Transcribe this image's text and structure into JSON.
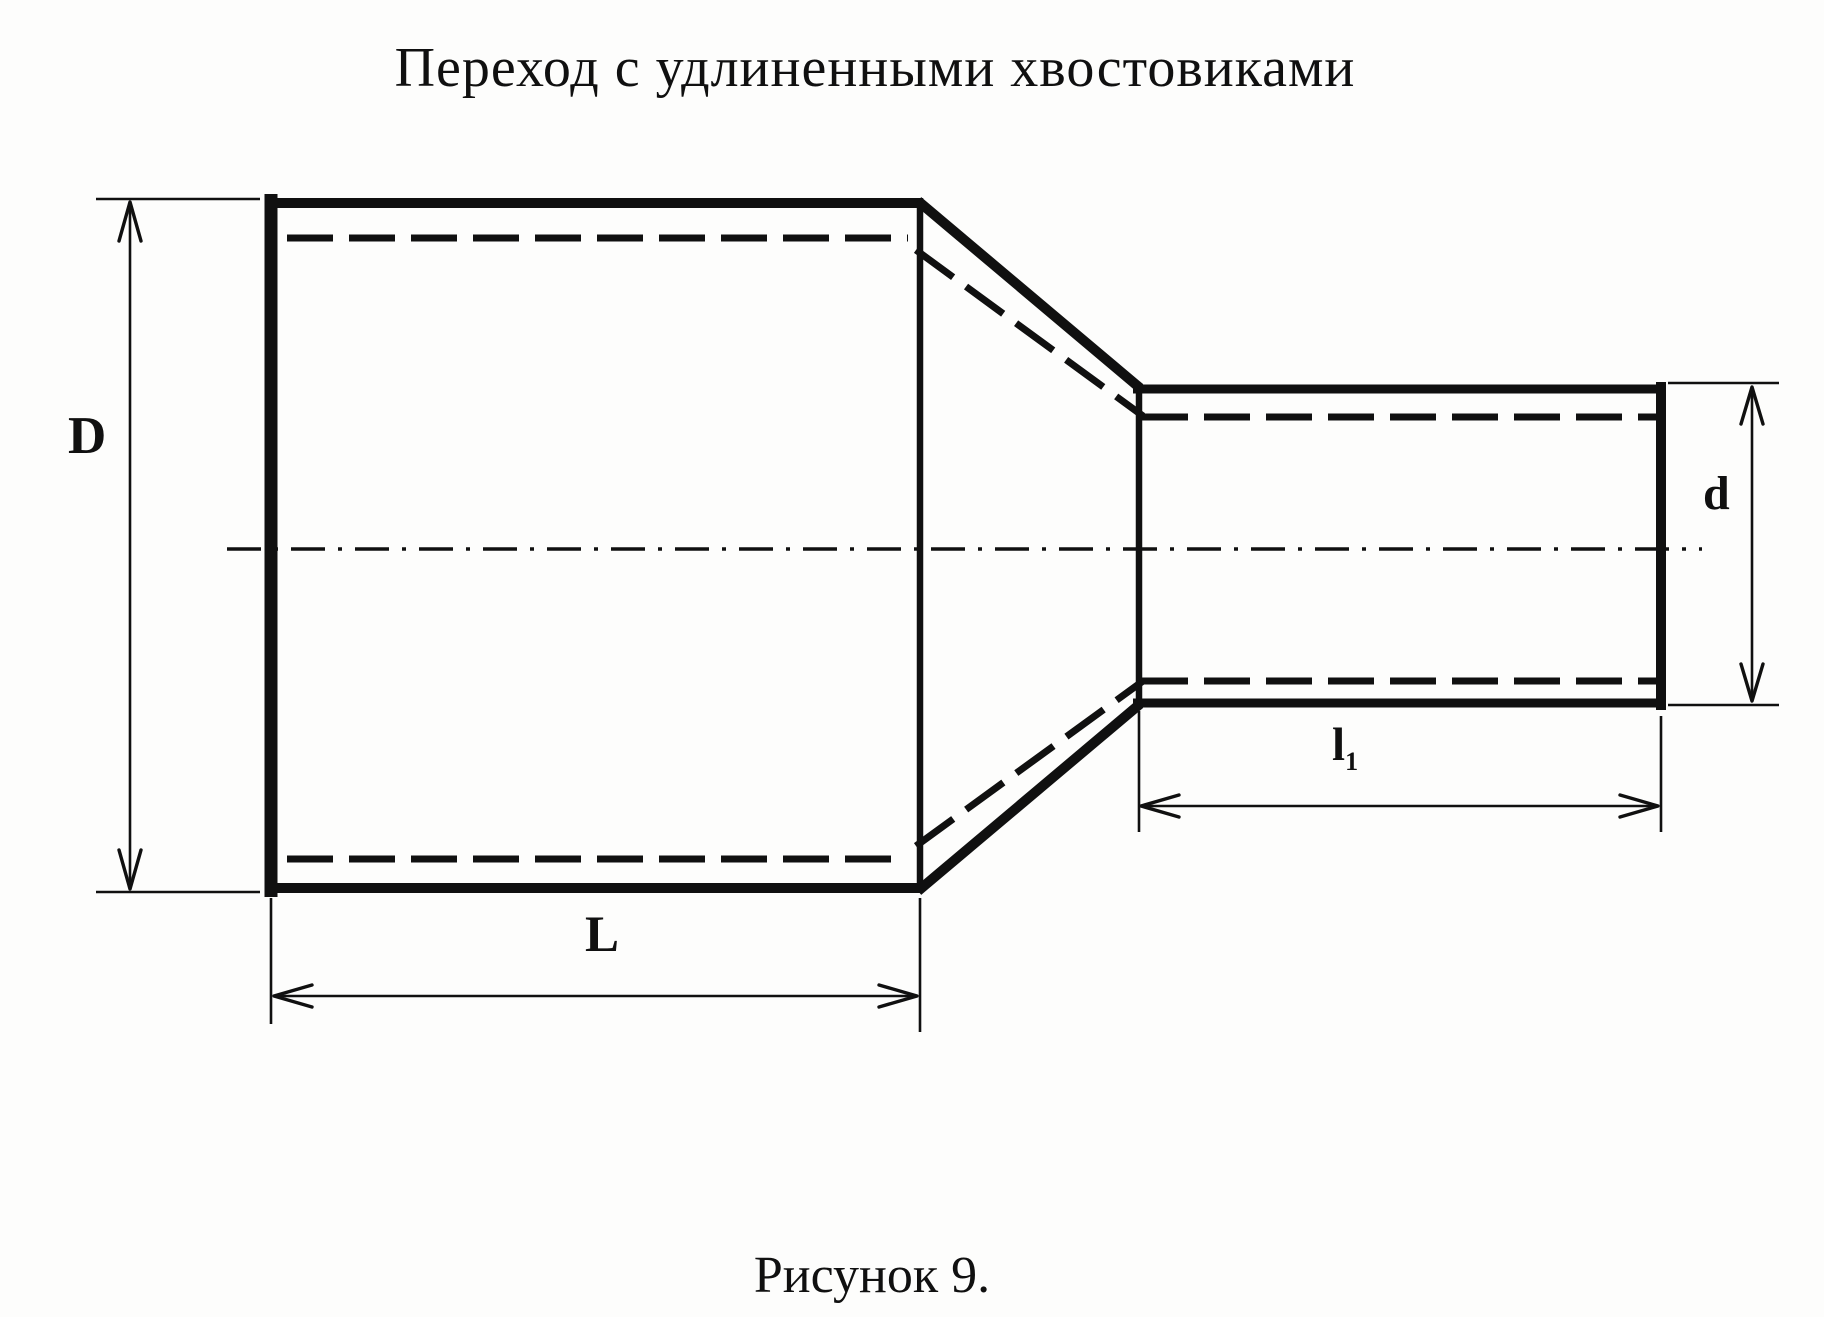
{
  "title": "Переход с удлиненными хвостовиками",
  "caption": "Рисунок 9.",
  "labels": {
    "large_diameter": "D",
    "small_diameter": "d",
    "large_length": "L",
    "small_length_main": "l",
    "small_length_sub": "1"
  },
  "colors": {
    "paper": "#fdfdfc",
    "ink": "#101010"
  }
}
